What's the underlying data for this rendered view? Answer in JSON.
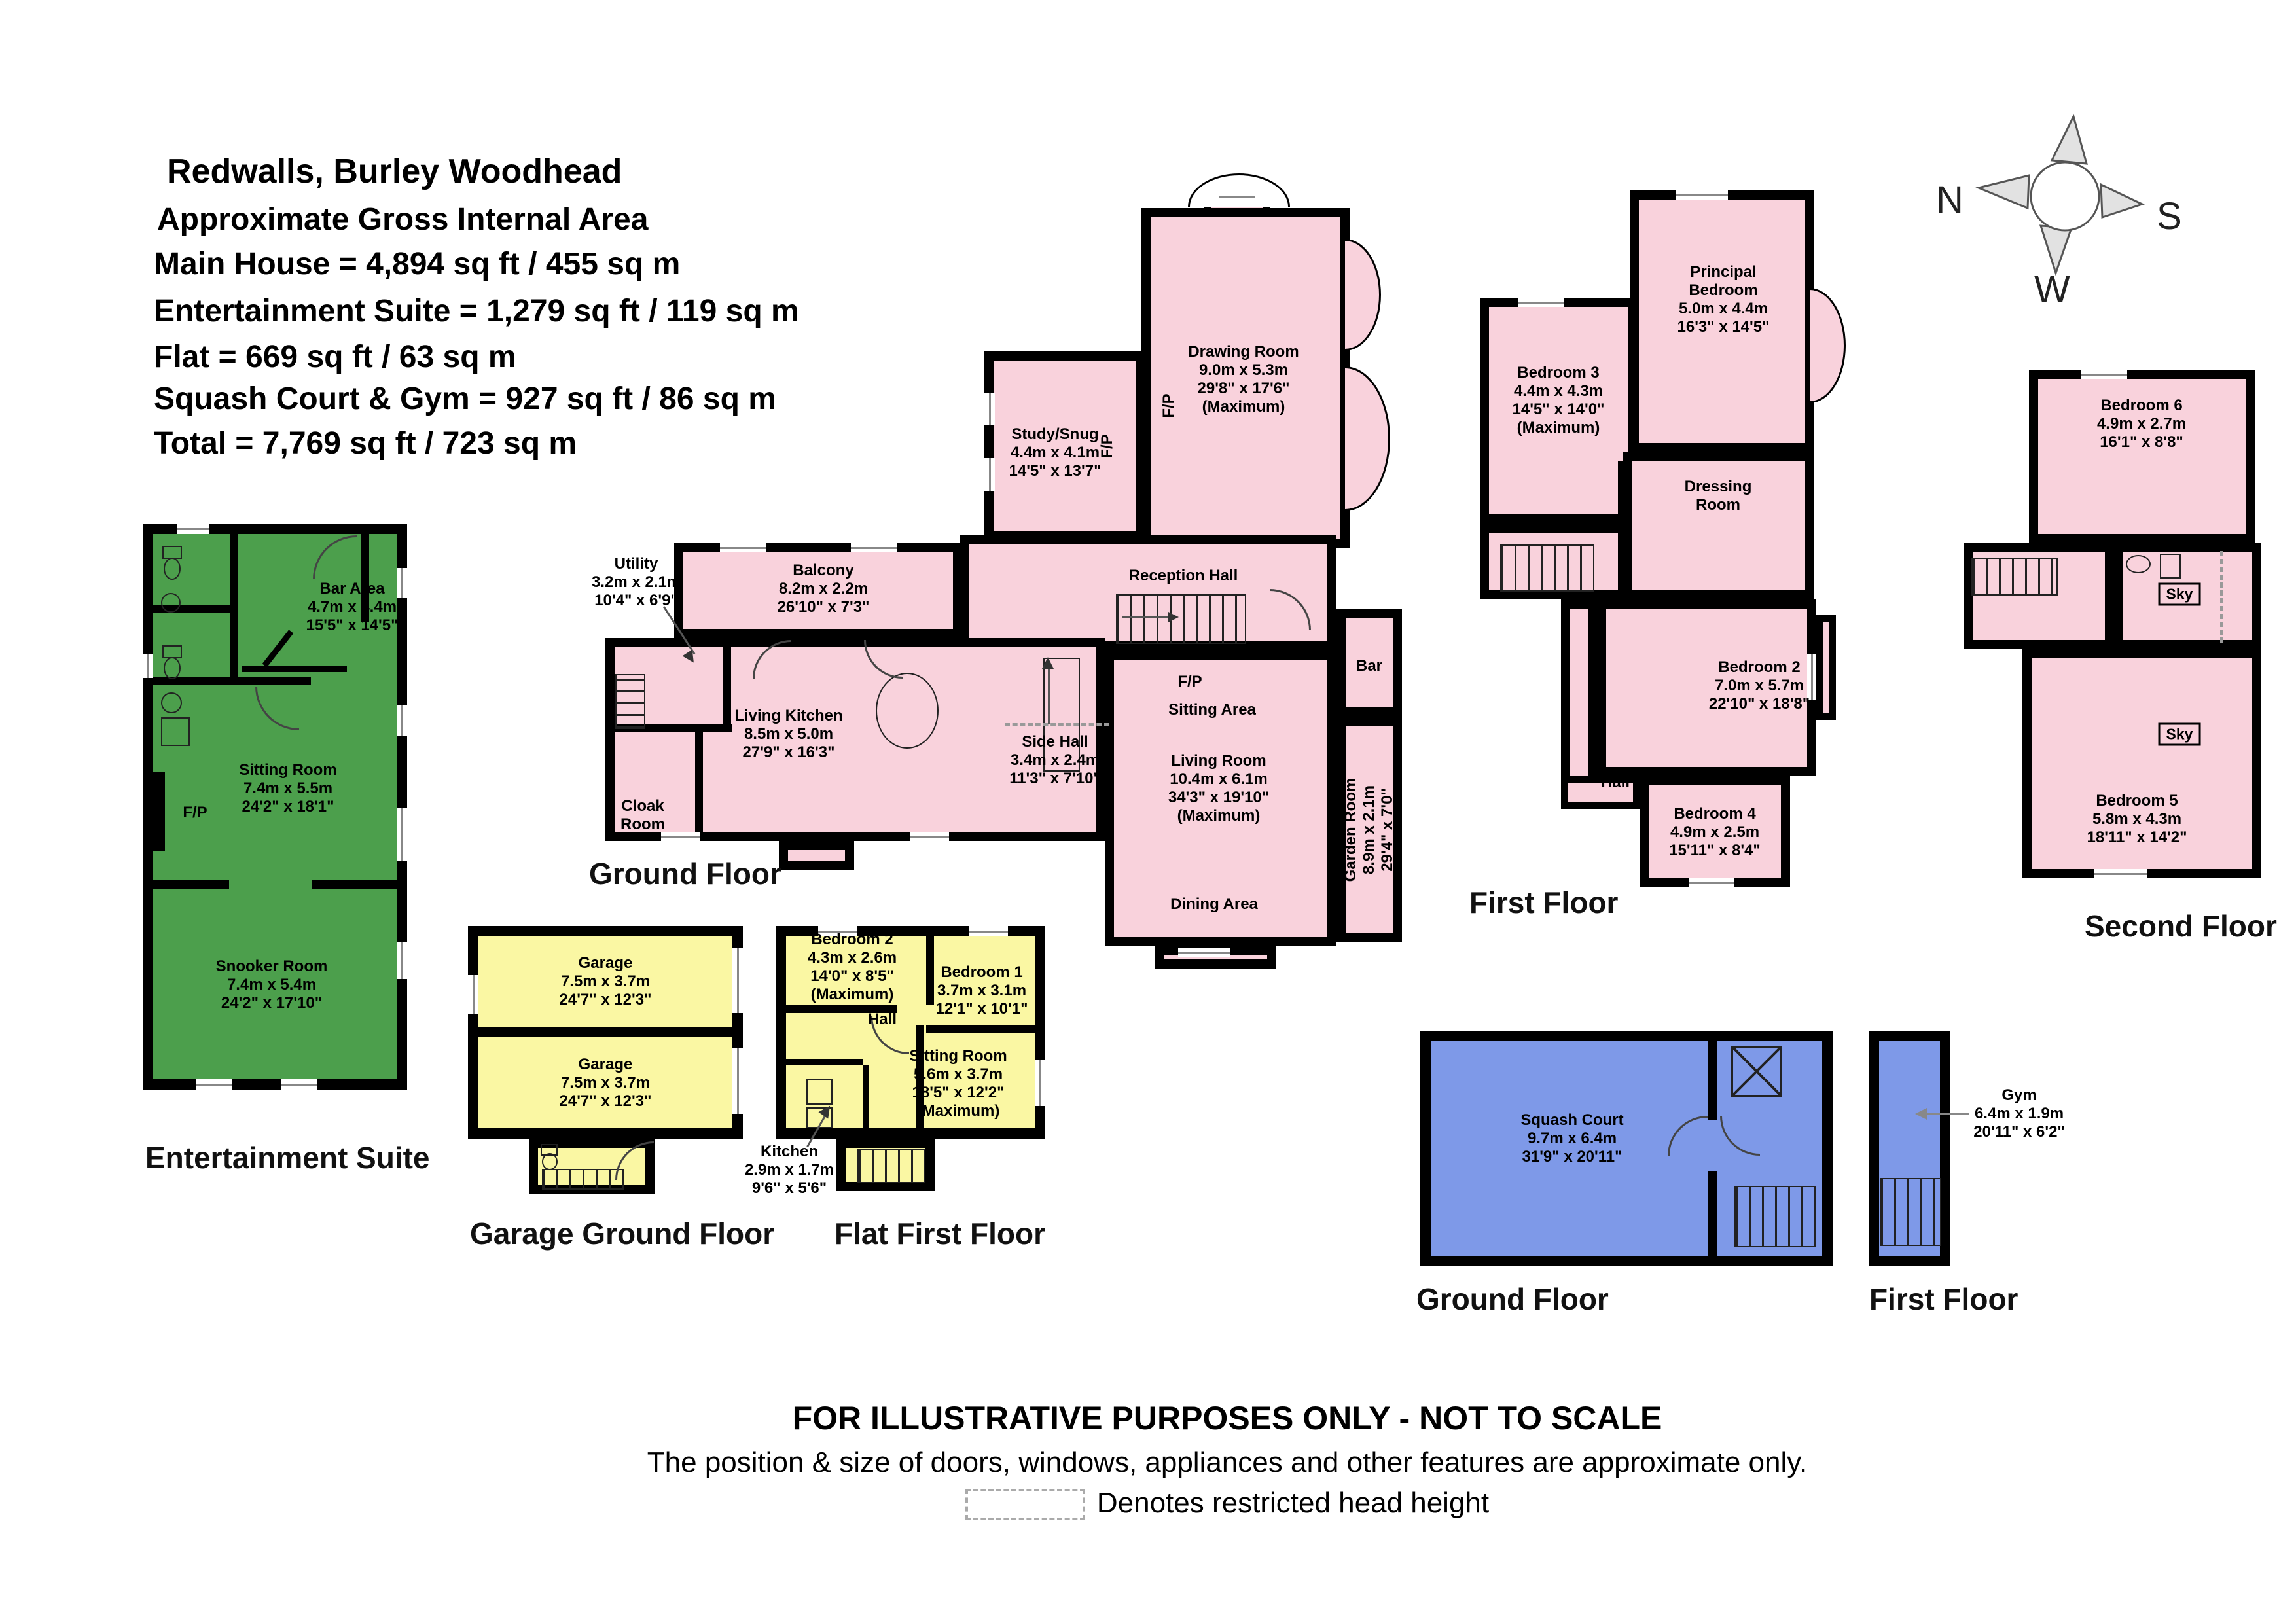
{
  "header": {
    "lines": [
      "Redwalls, Burley Woodhead",
      "Approximate Gross Internal Area",
      "Main House = 4,894 sq ft / 455 sq m",
      "Entertainment Suite = 1,279 sq ft / 119 sq m",
      "Flat = 669 sq ft / 63 sq m",
      "Squash Court & Gym = 927 sq ft / 86 sq m",
      "Total = 7,769 sq ft / 723 sq m"
    ]
  },
  "compass": {
    "n": "N",
    "s": "S",
    "w": "W"
  },
  "plans": {
    "entertainment": {
      "title": "Entertainment Suite",
      "rooms": {
        "bar": {
          "lines": [
            "Bar Area",
            "4.7m x 4.4m",
            "15'5\" x 14'5\""
          ]
        },
        "sitting": {
          "lines": [
            "Sitting Room",
            "7.4m x 5.5m",
            "24'2\" x 18'1\""
          ]
        },
        "snooker": {
          "lines": [
            "Snooker Room",
            "7.4m x 5.4m",
            "24'2\" x 17'10\""
          ]
        },
        "fp": "F/P"
      }
    },
    "main_ground": {
      "title": "Ground Floor",
      "rooms": {
        "drawing": {
          "lines": [
            "Drawing Room",
            "9.0m x 5.3m",
            "29'8\" x 17'6\"",
            "(Maximum)"
          ]
        },
        "study": {
          "lines": [
            "Study/Snug",
            "4.4m x 4.1m",
            "14'5\" x 13'7\""
          ]
        },
        "utility": {
          "lines": [
            "Utility",
            "3.2m x 2.1m",
            "10'4\" x 6'9\""
          ]
        },
        "balcony": {
          "lines": [
            "Balcony",
            "8.2m x 2.2m",
            "26'10\" x 7'3\""
          ]
        },
        "living_kitchen": {
          "lines": [
            "Living Kitchen",
            "8.5m x 5.0m",
            "27'9\" x 16'3\""
          ]
        },
        "cloak": {
          "lines": [
            "Cloak",
            "Room"
          ]
        },
        "side_hall": {
          "lines": [
            "Side Hall",
            "3.4m x 2.4m",
            "11'3\" x 7'10\""
          ]
        },
        "reception": {
          "lines": [
            "Reception Hall"
          ]
        },
        "sitting_area": {
          "lines": [
            "Sitting Area"
          ]
        },
        "living": {
          "lines": [
            "Living Room",
            "10.4m x 6.1m",
            "34'3\" x 19'10\"",
            "(Maximum)"
          ]
        },
        "dining": {
          "lines": [
            "Dining Area"
          ]
        },
        "bar": {
          "lines": [
            "Bar"
          ]
        },
        "garden": {
          "lines": [
            "Garden Room",
            "8.9m x 2.1m",
            "29'4\" x 7'0\""
          ]
        },
        "fp": "F/P"
      }
    },
    "first": {
      "title": "First Floor",
      "rooms": {
        "bed3": {
          "lines": [
            "Bedroom 3",
            "4.4m x 4.3m",
            "14'5\" x 14'0\"",
            "(Maximum)"
          ]
        },
        "principal": {
          "lines": [
            "Principal",
            "Bedroom",
            "5.0m x 4.4m",
            "16'3\" x 14'5\""
          ]
        },
        "dressing": {
          "lines": [
            "Dressing",
            "Room"
          ]
        },
        "bed2": {
          "lines": [
            "Bedroom 2",
            "7.0m x 5.7m",
            "22'10\" x 18'8\""
          ]
        },
        "hall": {
          "lines": [
            "Hall"
          ]
        },
        "bed4": {
          "lines": [
            "Bedroom 4",
            "4.9m x 2.5m",
            "15'11\" x 8'4\""
          ]
        }
      }
    },
    "second": {
      "title": "Second Floor",
      "rooms": {
        "bed6": {
          "lines": [
            "Bedroom 6",
            "4.9m x 2.7m",
            "16'1\" x 8'8\""
          ]
        },
        "bed5": {
          "lines": [
            "Bedroom 5",
            "5.8m x 4.3m",
            "18'11\" x 14'2\""
          ]
        },
        "sky": "Sky"
      }
    },
    "garage": {
      "title": "Garage Ground Floor",
      "rooms": {
        "g1": {
          "lines": [
            "Garage",
            "7.5m x 3.7m",
            "24'7\" x 12'3\""
          ]
        },
        "g2": {
          "lines": [
            "Garage",
            "7.5m x 3.7m",
            "24'7\" x 12'3\""
          ]
        }
      }
    },
    "flat": {
      "title": "Flat First Floor",
      "rooms": {
        "bed2": {
          "lines": [
            "Bedroom 2",
            "4.3m x 2.6m",
            "14'0\" x 8'5\"",
            "(Maximum)"
          ]
        },
        "bed1": {
          "lines": [
            "Bedroom 1",
            "3.7m x 3.1m",
            "12'1\" x 10'1\""
          ]
        },
        "hall": {
          "lines": [
            "Hall"
          ]
        },
        "sitting": {
          "lines": [
            "Sitting Room",
            "5.6m x 3.7m",
            "18'5\" x 12'2\"",
            "(Maximum)"
          ]
        },
        "kitchen": {
          "lines": [
            "Kitchen",
            "2.9m x 1.7m",
            "9'6\" x 5'6\""
          ]
        }
      }
    },
    "squash": {
      "title": "Ground Floor",
      "rooms": {
        "court": {
          "lines": [
            "Squash Court",
            "9.7m x 6.4m",
            "31'9\" x 20'11\""
          ]
        }
      }
    },
    "gym": {
      "title": "First Floor",
      "rooms": {
        "gym": {
          "lines": [
            "Gym",
            "6.4m x 1.9m",
            "20'11\" x 6'2\""
          ]
        }
      }
    }
  },
  "footer": {
    "line1": "FOR ILLUSTRATIVE PURPOSES ONLY - NOT TO SCALE",
    "line2": "The position & size of doors, windows, appliances and other features are approximate only.",
    "legend": "Denotes restricted head height"
  },
  "colors": {
    "pink": "#F9D2DC",
    "green": "#4C9F4C",
    "yellow": "#FAF7A3",
    "blue": "#7E99E8",
    "wall": "#000000"
  }
}
